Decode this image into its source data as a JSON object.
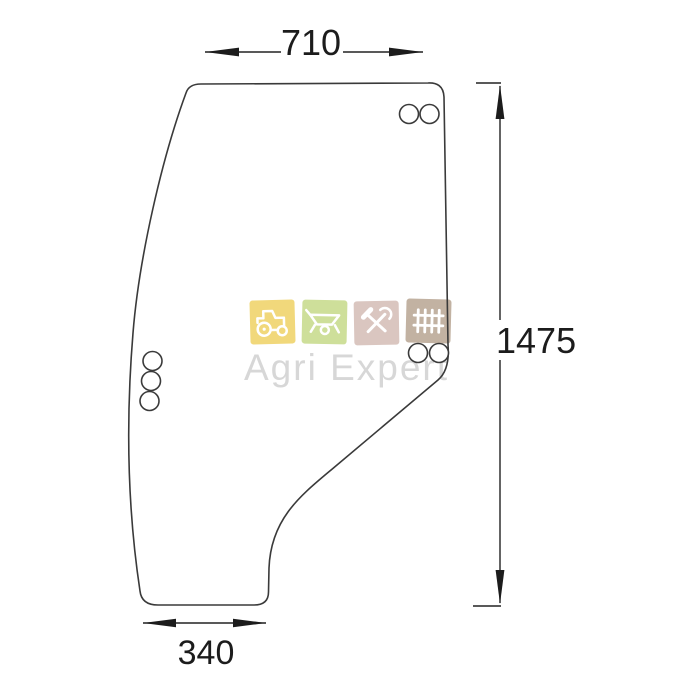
{
  "drawing": {
    "type": "technical-diagram",
    "subject": "door-glass-panel",
    "line_color": "#3a3a3a",
    "dim_color": "#1c1c1c",
    "dimensions": {
      "top_width": "710",
      "right_height": "1475",
      "bottom_width": "340"
    },
    "holes": {
      "top_right_count": 2,
      "mid_right_count": 2,
      "left_count": 3
    }
  },
  "watermark": {
    "brand": "Agri Expert",
    "text_color": "#d7d7d7",
    "icons": [
      {
        "name": "tractor-icon",
        "color": "#f1d87b"
      },
      {
        "name": "wheelbarrow-icon",
        "color": "#cedf9a"
      },
      {
        "name": "tools-icon",
        "color": "#dac6c0"
      },
      {
        "name": "fence-icon",
        "color": "#c2b2a2"
      }
    ]
  }
}
